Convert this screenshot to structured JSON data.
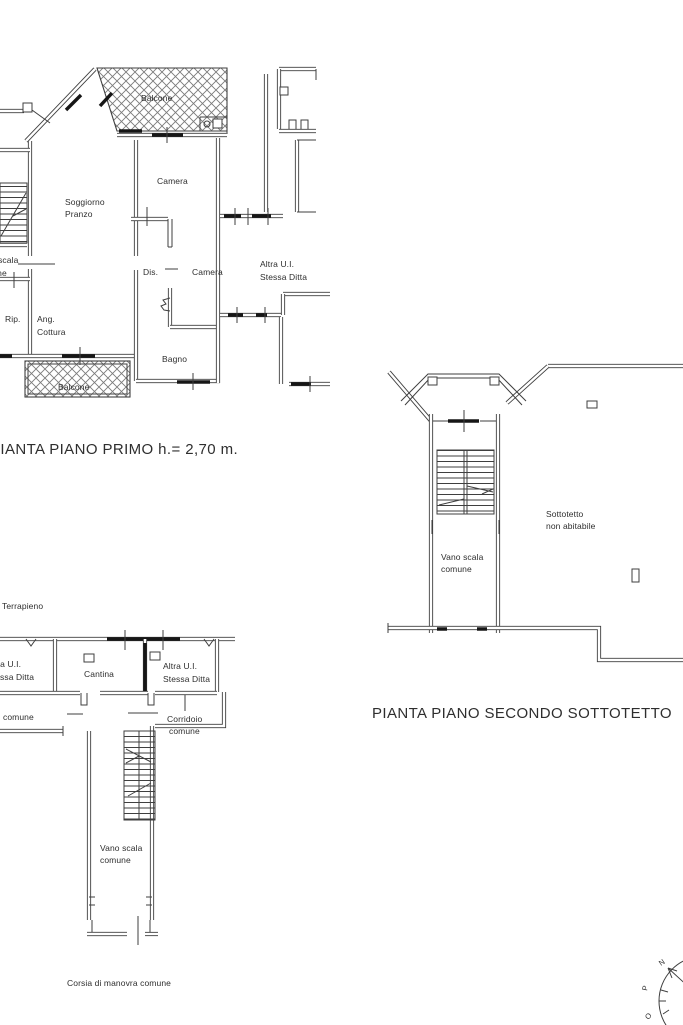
{
  "colors": {
    "line": "#3f3f3f",
    "text": "#2e2e2e",
    "dark": "#161616",
    "hatch": "#7a7a7a",
    "bg": "#ffffff"
  },
  "plan_primo": {
    "caption": "PIANTA PIANO PRIMO h.= 2,70 m.",
    "labels": {
      "balcone_top": "Balcone",
      "camera_top": "Camera",
      "soggiorno": [
        "Soggiorno",
        "Pranzo"
      ],
      "vano_scala": [
        "Vano scala",
        "comune"
      ],
      "dis": "Dis.",
      "camera_mid": "Camera",
      "altra_ui": [
        "Altra U.I.",
        "Stessa Ditta"
      ],
      "rip": "Rip.",
      "ang_cottura": [
        "Ang.",
        "Cottura"
      ],
      "bagno": "Bagno",
      "balcone_bottom": "Balcone"
    }
  },
  "plan_sottotetto": {
    "caption": "PIANTA PIANO SECONDO SOTTOTETTO",
    "labels": {
      "sottotetto": [
        "Sottotetto",
        "non abitabile"
      ],
      "vano_scala": [
        "Vano scala",
        "comune"
      ]
    }
  },
  "plan_interrato": {
    "labels": {
      "terrapieno": "Terrapieno",
      "altra_ui_left": [
        "Altra U.I.",
        "Stessa Ditta"
      ],
      "cantina": "Cantina",
      "altra_ui_right": [
        "Altra U.I.",
        "Stessa Ditta"
      ],
      "comune_left": "comune",
      "corridoio": [
        "Corridoio",
        "comune"
      ],
      "vano_scala": [
        "Vano scala",
        "comune"
      ],
      "corsia": "Corsia di manovra comune"
    }
  },
  "compass": {
    "n": "N",
    "p": "P",
    "o": "O"
  }
}
